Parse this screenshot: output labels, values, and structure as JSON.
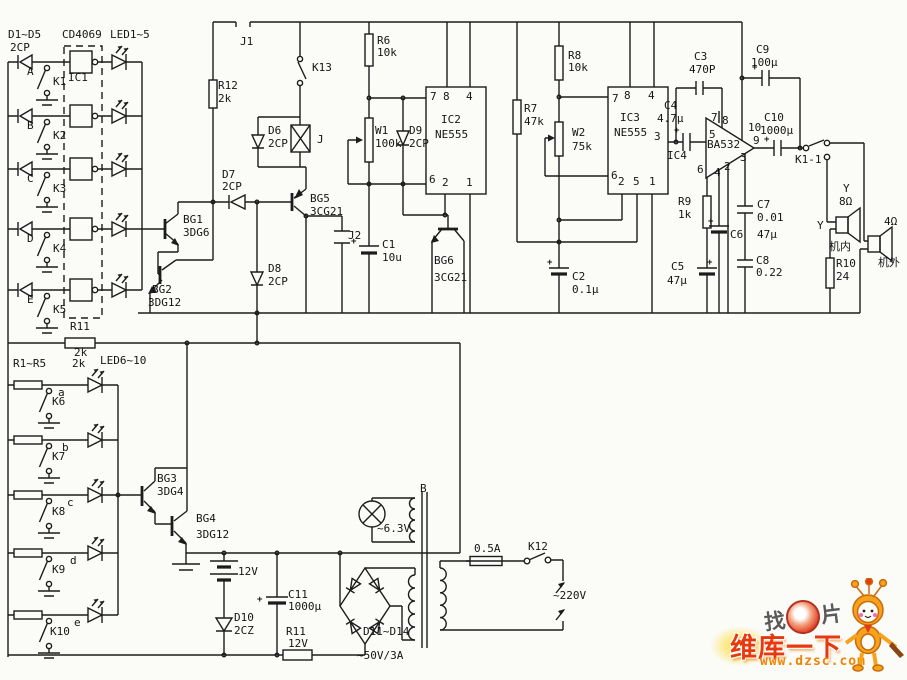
{
  "page": {
    "width": 907,
    "height": 680,
    "background": "#fbfbf8",
    "ink": "#1c1c1c",
    "type": "scanned circuit schematic"
  },
  "watermark": {
    "prefix": "找",
    "suffix": "片",
    "brand": "维库一下",
    "url": "www.dzsc.com",
    "brand_color": "#e8380d",
    "url_color": "#f08300"
  },
  "labels": [
    {
      "n": "label-d-group",
      "t": "D1~D5",
      "x": 8,
      "y": 29
    },
    {
      "n": "label-d-group-type",
      "t": "2CP",
      "x": 10,
      "y": 42
    },
    {
      "n": "label-ic1-part",
      "t": "CD4069",
      "x": 62,
      "y": 29
    },
    {
      "n": "label-led-group-top",
      "t": "LED1~5",
      "x": 110,
      "y": 29
    },
    {
      "n": "label-input-a",
      "t": "A",
      "x": 27,
      "y": 66
    },
    {
      "n": "label-ic1",
      "t": "IC1",
      "x": 68,
      "y": 72
    },
    {
      "n": "label-k1",
      "t": "K1",
      "x": 53,
      "y": 76
    },
    {
      "n": "label-input-b",
      "t": "B",
      "x": 27,
      "y": 120
    },
    {
      "n": "label-k2",
      "t": "K2",
      "x": 53,
      "y": 130
    },
    {
      "n": "label-input-c",
      "t": "C",
      "x": 27,
      "y": 173
    },
    {
      "n": "label-k3",
      "t": "K3",
      "x": 53,
      "y": 183
    },
    {
      "n": "label-input-d",
      "t": "D",
      "x": 27,
      "y": 233
    },
    {
      "n": "label-k4",
      "t": "K4",
      "x": 53,
      "y": 243
    },
    {
      "n": "label-input-e",
      "t": "E",
      "x": 27,
      "y": 294
    },
    {
      "n": "label-k5",
      "t": "K5",
      "x": 53,
      "y": 304
    },
    {
      "n": "label-j1",
      "t": "J1",
      "x": 240,
      "y": 36
    },
    {
      "n": "label-r12",
      "t": "R12",
      "x": 218,
      "y": 80
    },
    {
      "n": "label-r12-val",
      "t": "2k",
      "x": 218,
      "y": 93
    },
    {
      "n": "label-k13",
      "t": "K13",
      "x": 312,
      "y": 62
    },
    {
      "n": "label-d6",
      "t": "D6",
      "x": 268,
      "y": 125
    },
    {
      "n": "label-d6-type",
      "t": "2CP",
      "x": 268,
      "y": 138
    },
    {
      "n": "label-j-coil",
      "t": "J",
      "x": 317,
      "y": 134
    },
    {
      "n": "label-d7",
      "t": "D7",
      "x": 222,
      "y": 169
    },
    {
      "n": "label-d7-type",
      "t": "2CP",
      "x": 222,
      "y": 181
    },
    {
      "n": "label-bg1",
      "t": "BG1",
      "x": 183,
      "y": 214
    },
    {
      "n": "label-bg1-type",
      "t": "3DG6",
      "x": 183,
      "y": 227
    },
    {
      "n": "label-bg2",
      "t": "BG2",
      "x": 152,
      "y": 284
    },
    {
      "n": "label-bg2-type",
      "t": "3DG12",
      "x": 148,
      "y": 297
    },
    {
      "n": "label-d8",
      "t": "D8",
      "x": 268,
      "y": 263
    },
    {
      "n": "label-d8-type",
      "t": "2CP",
      "x": 268,
      "y": 276
    },
    {
      "n": "label-bg5",
      "t": "BG5",
      "x": 310,
      "y": 193
    },
    {
      "n": "label-bg5-type",
      "t": "3CG21",
      "x": 310,
      "y": 206
    },
    {
      "n": "label-j2",
      "t": "J2",
      "x": 348,
      "y": 230
    },
    {
      "n": "label-c1",
      "t": "C1",
      "x": 382,
      "y": 239
    },
    {
      "n": "label-c1-val",
      "t": "10u",
      "x": 382,
      "y": 252
    },
    {
      "n": "label-r6",
      "t": "R6",
      "x": 377,
      "y": 35
    },
    {
      "n": "label-r6-val",
      "t": "10k",
      "x": 377,
      "y": 47
    },
    {
      "n": "label-w1",
      "t": "W1",
      "x": 375,
      "y": 125
    },
    {
      "n": "label-w1-val",
      "t": "100k",
      "x": 375,
      "y": 138
    },
    {
      "n": "label-d9",
      "t": "D9",
      "x": 409,
      "y": 125
    },
    {
      "n": "label-d9-type",
      "t": "2CP",
      "x": 409,
      "y": 138
    },
    {
      "n": "label-ic2-pin7",
      "t": "7",
      "x": 430,
      "y": 91
    },
    {
      "n": "label-ic2-pin8",
      "t": "8",
      "x": 443,
      "y": 91
    },
    {
      "n": "label-ic2-pin4",
      "t": "4",
      "x": 466,
      "y": 91
    },
    {
      "n": "label-ic2",
      "t": "IC2",
      "x": 441,
      "y": 114
    },
    {
      "n": "label-ic2-part",
      "t": "NE555",
      "x": 435,
      "y": 129
    },
    {
      "n": "label-ic2-pin6",
      "t": "6",
      "x": 429,
      "y": 174
    },
    {
      "n": "label-ic2-pin2",
      "t": "2",
      "x": 442,
      "y": 177
    },
    {
      "n": "label-ic2-pin1",
      "t": "1",
      "x": 466,
      "y": 177
    },
    {
      "n": "label-bg6",
      "t": "BG6",
      "x": 434,
      "y": 255
    },
    {
      "n": "label-bg6-type",
      "t": "3CG21",
      "x": 434,
      "y": 272
    },
    {
      "n": "label-c2",
      "t": "C2",
      "x": 572,
      "y": 271
    },
    {
      "n": "label-c2-val",
      "t": "0.1μ",
      "x": 572,
      "y": 284
    },
    {
      "n": "label-r7",
      "t": "R7",
      "x": 524,
      "y": 103
    },
    {
      "n": "label-r7-val",
      "t": "47k",
      "x": 524,
      "y": 116
    },
    {
      "n": "label-r8",
      "t": "R8",
      "x": 568,
      "y": 50
    },
    {
      "n": "label-r8-val",
      "t": "10k",
      "x": 568,
      "y": 62
    },
    {
      "n": "label-w2",
      "t": "W2",
      "x": 572,
      "y": 127
    },
    {
      "n": "label-w2-val",
      "t": "75k",
      "x": 572,
      "y": 141
    },
    {
      "n": "label-ic3-pin7",
      "t": "7",
      "x": 612,
      "y": 93
    },
    {
      "n": "label-ic3-pin8",
      "t": "8",
      "x": 624,
      "y": 90
    },
    {
      "n": "label-ic3-pin4",
      "t": "4",
      "x": 648,
      "y": 90
    },
    {
      "n": "label-ic3",
      "t": "IC3",
      "x": 620,
      "y": 112
    },
    {
      "n": "label-ic3-part",
      "t": "NE555",
      "x": 614,
      "y": 127
    },
    {
      "n": "label-ic3-pin3",
      "t": "3",
      "x": 654,
      "y": 131
    },
    {
      "n": "label-ic3-pin6",
      "t": "6",
      "x": 611,
      "y": 170
    },
    {
      "n": "label-ic3-pin2",
      "t": "2",
      "x": 618,
      "y": 176
    },
    {
      "n": "label-ic3-pin5",
      "t": "5",
      "x": 633,
      "y": 176
    },
    {
      "n": "label-ic3-pin1",
      "t": "1",
      "x": 649,
      "y": 176
    },
    {
      "n": "label-c4",
      "t": "C4",
      "x": 664,
      "y": 100
    },
    {
      "n": "label-c4-val",
      "t": "4.7μ",
      "x": 657,
      "y": 113
    },
    {
      "n": "label-ic4",
      "t": "IC4",
      "x": 667,
      "y": 150
    },
    {
      "n": "label-ba532",
      "t": "BA532",
      "x": 707,
      "y": 139
    },
    {
      "n": "label-ic4-pin7",
      "t": "7",
      "x": 711,
      "y": 112
    },
    {
      "n": "label-ic4-pin8",
      "t": "8",
      "x": 722,
      "y": 115
    },
    {
      "n": "label-ic4-pin5",
      "t": "5",
      "x": 709,
      "y": 129
    },
    {
      "n": "label-ic4-pin6",
      "t": "6",
      "x": 697,
      "y": 164
    },
    {
      "n": "label-ic4-pin4",
      "t": "4",
      "x": 714,
      "y": 167
    },
    {
      "n": "label-ic4-pin2",
      "t": "2",
      "x": 724,
      "y": 161
    },
    {
      "n": "label-ic4-pin3",
      "t": "3",
      "x": 740,
      "y": 152
    },
    {
      "n": "label-ic4-pin10",
      "t": "10",
      "x": 748,
      "y": 122
    },
    {
      "n": "label-ic4-pin9",
      "t": "9",
      "x": 753,
      "y": 135
    },
    {
      "n": "label-c10",
      "t": "C10",
      "x": 764,
      "y": 112
    },
    {
      "n": "label-c10-val",
      "t": "1000μ",
      "x": 760,
      "y": 125
    },
    {
      "n": "label-c9",
      "t": "C9",
      "x": 756,
      "y": 44
    },
    {
      "n": "label-c9-val",
      "t": "100μ",
      "x": 751,
      "y": 57
    },
    {
      "n": "label-c3",
      "t": "C3",
      "x": 694,
      "y": 51
    },
    {
      "n": "label-c3-val",
      "t": "470P",
      "x": 689,
      "y": 64
    },
    {
      "n": "label-k1-1",
      "t": "K1-1",
      "x": 795,
      "y": 154
    },
    {
      "n": "label-r9",
      "t": "R9",
      "x": 678,
      "y": 196
    },
    {
      "n": "label-r9-val",
      "t": "1k",
      "x": 678,
      "y": 209
    },
    {
      "n": "label-c6",
      "t": "C6",
      "x": 730,
      "y": 229
    },
    {
      "n": "label-c7",
      "t": "C7",
      "x": 757,
      "y": 199
    },
    {
      "n": "label-c7-val",
      "t": "0.01",
      "x": 757,
      "y": 212
    },
    {
      "n": "label-c6-val",
      "t": "47μ",
      "x": 757,
      "y": 229
    },
    {
      "n": "label-c5",
      "t": "C5",
      "x": 671,
      "y": 261
    },
    {
      "n": "label-c5-val",
      "t": "47μ",
      "x": 667,
      "y": 275
    },
    {
      "n": "label-c8",
      "t": "C8",
      "x": 756,
      "y": 255
    },
    {
      "n": "label-c8-val",
      "t": "0.22",
      "x": 756,
      "y": 267
    },
    {
      "n": "label-speaker-y",
      "t": "Y",
      "x": 843,
      "y": 183
    },
    {
      "n": "label-speaker-y-val",
      "t": "8Ω",
      "x": 839,
      "y": 196
    },
    {
      "n": "label-speaker-y2",
      "t": "Y",
      "x": 817,
      "y": 220
    },
    {
      "n": "label-internal",
      "t": "机内",
      "x": 829,
      "y": 241
    },
    {
      "n": "label-r10",
      "t": "R10",
      "x": 836,
      "y": 258
    },
    {
      "n": "label-r10-val",
      "t": "24",
      "x": 836,
      "y": 271
    },
    {
      "n": "label-ext-val",
      "t": "4Ω",
      "x": 884,
      "y": 216
    },
    {
      "n": "label-external",
      "t": "机外",
      "x": 878,
      "y": 257
    },
    {
      "n": "label-r11a",
      "t": "R11",
      "x": 70,
      "y": 321
    },
    {
      "n": "label-r11a-val",
      "t": "2k",
      "x": 74,
      "y": 347
    },
    {
      "n": "label-r-group",
      "t": "R1~R5",
      "x": 13,
      "y": 358
    },
    {
      "n": "label-r-group-val",
      "t": "2k",
      "x": 72,
      "y": 358
    },
    {
      "n": "label-led-group-bot",
      "t": "LED6~10",
      "x": 100,
      "y": 355
    },
    {
      "n": "label-input-a2",
      "t": "a",
      "x": 58,
      "y": 387
    },
    {
      "n": "label-k6",
      "t": "K6",
      "x": 52,
      "y": 396
    },
    {
      "n": "label-input-b2",
      "t": "b",
      "x": 62,
      "y": 442
    },
    {
      "n": "label-k7",
      "t": "K7",
      "x": 52,
      "y": 451
    },
    {
      "n": "label-input-c2",
      "t": "c",
      "x": 67,
      "y": 497
    },
    {
      "n": "label-k8",
      "t": "K8",
      "x": 52,
      "y": 506
    },
    {
      "n": "label-input-d2",
      "t": "d",
      "x": 70,
      "y": 555
    },
    {
      "n": "label-k9",
      "t": "K9",
      "x": 52,
      "y": 564
    },
    {
      "n": "label-input-e2",
      "t": "e",
      "x": 74,
      "y": 617
    },
    {
      "n": "label-k10",
      "t": "K10",
      "x": 50,
      "y": 626
    },
    {
      "n": "label-bg3",
      "t": "BG3",
      "x": 157,
      "y": 473
    },
    {
      "n": "label-bg3-type",
      "t": "3DG4",
      "x": 157,
      "y": 486
    },
    {
      "n": "label-bg4",
      "t": "BG4",
      "x": 196,
      "y": 513
    },
    {
      "n": "label-bg4-type",
      "t": "3DG12",
      "x": 196,
      "y": 529
    },
    {
      "n": "label-battery",
      "t": "12V",
      "x": 238,
      "y": 566
    },
    {
      "n": "label-d10",
      "t": "D10",
      "x": 234,
      "y": 612
    },
    {
      "n": "label-d10-type",
      "t": "2CZ",
      "x": 234,
      "y": 625
    },
    {
      "n": "label-c11",
      "t": "C11",
      "x": 288,
      "y": 589
    },
    {
      "n": "label-c11-val",
      "t": "1000μ",
      "x": 288,
      "y": 601
    },
    {
      "n": "label-r11b",
      "t": "R11",
      "x": 286,
      "y": 626
    },
    {
      "n": "label-r11b-val",
      "t": "12V",
      "x": 288,
      "y": 638
    },
    {
      "n": "label-bridge",
      "t": "D11~D14",
      "x": 363,
      "y": 626
    },
    {
      "n": "label-bridge-val",
      "t": "~50V/3A",
      "x": 357,
      "y": 650
    },
    {
      "n": "label-lamp",
      "t": "~6.3V",
      "x": 377,
      "y": 523
    },
    {
      "n": "label-transformer",
      "t": "B",
      "x": 420,
      "y": 483
    },
    {
      "n": "label-fuse",
      "t": "0.5A",
      "x": 474,
      "y": 543
    },
    {
      "n": "label-k12",
      "t": "K12",
      "x": 528,
      "y": 541
    },
    {
      "n": "label-mains",
      "t": "~220V",
      "x": 553,
      "y": 590
    },
    {
      "n": "plus-c1",
      "t": "+",
      "x": 351,
      "y": 238,
      "c": "plus"
    },
    {
      "n": "plus-c4",
      "t": "+",
      "x": 674,
      "y": 127,
      "c": "plus"
    },
    {
      "n": "plus-c9",
      "t": "+",
      "x": 752,
      "y": 64,
      "c": "plus"
    },
    {
      "n": "plus-c10",
      "t": "+",
      "x": 764,
      "y": 136,
      "c": "plus"
    },
    {
      "n": "plus-c5",
      "t": "+",
      "x": 707,
      "y": 259,
      "c": "plus"
    },
    {
      "n": "plus-c6",
      "t": "+",
      "x": 708,
      "y": 218,
      "c": "plus"
    },
    {
      "n": "plus-c2",
      "t": "+",
      "x": 547,
      "y": 259,
      "c": "plus"
    },
    {
      "n": "plus-c11",
      "t": "+",
      "x": 257,
      "y": 596,
      "c": "plus"
    }
  ]
}
